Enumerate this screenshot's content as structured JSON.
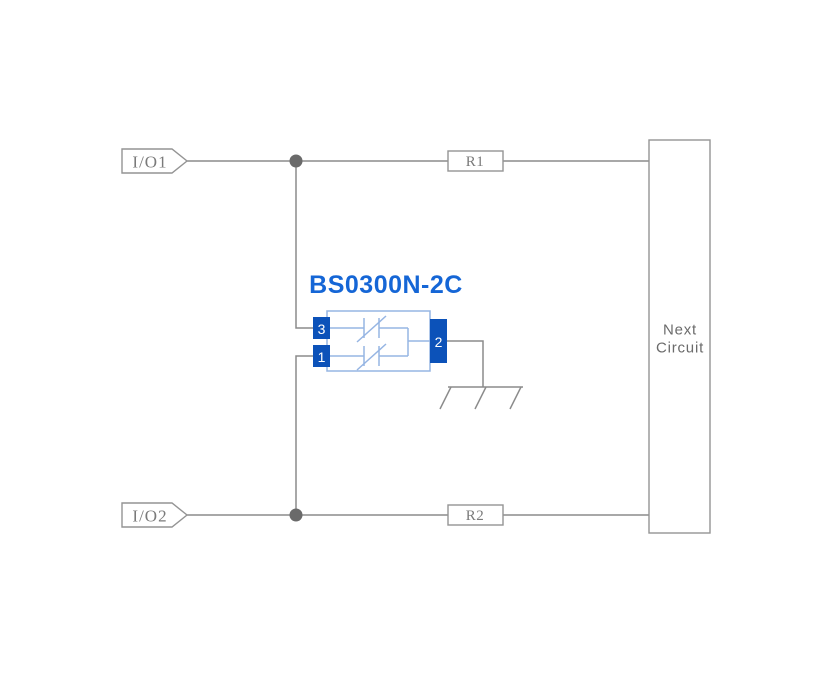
{
  "schematic": {
    "component": {
      "title": "BS0300N-2C",
      "pins": {
        "top_left": "3",
        "bottom_left": "1",
        "right": "2"
      }
    },
    "ports": {
      "io1": "I/O1",
      "io2": "I/O2"
    },
    "resistors": {
      "r1": "R1",
      "r2": "R2"
    },
    "next_circuit": {
      "line1": "Next",
      "line2": "Circuit"
    }
  },
  "colors": {
    "wire": "#8b8b8b",
    "outline": "#949494",
    "junction": "#6a6a6a",
    "label": "#7a7a7a",
    "next-text": "#6b6b6b",
    "title": "#1566d6",
    "pin": "#0c52b9",
    "component-light": "#96b5e3",
    "background": "#ffffff"
  }
}
